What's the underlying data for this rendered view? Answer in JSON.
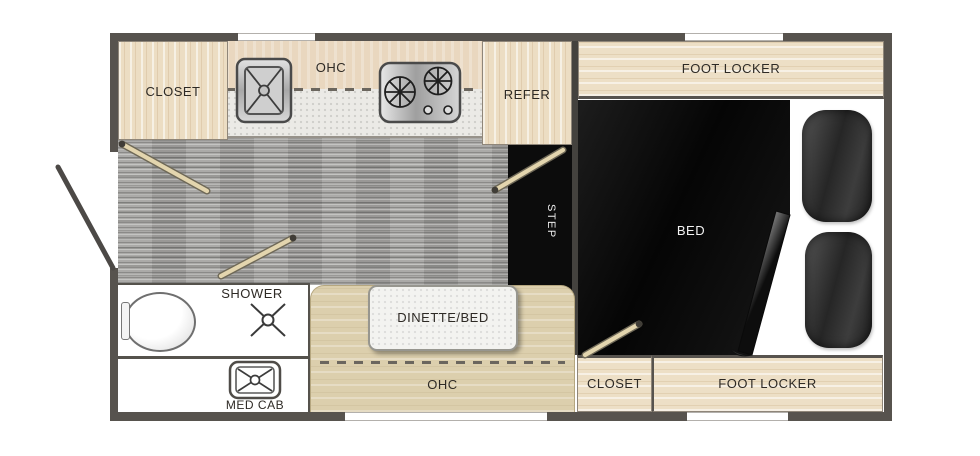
{
  "floorplan": {
    "kitchen": {
      "closet": "CLOSET",
      "ohc": "OHC",
      "refer": "REFER"
    },
    "front": {
      "foot_locker": "FOOT LOCKER",
      "bed": "BED",
      "step": "STEP"
    },
    "bath": {
      "shower": "SHOWER",
      "med_cab": "MED CAB"
    },
    "dinette": {
      "table": "DINETTE/BED",
      "ohc": "OHC"
    },
    "rear": {
      "closet": "CLOSET",
      "foot_locker": "FOOT LOCKER"
    },
    "icons": {
      "sink": "sink-icon",
      "stove": "stove-burners-icon",
      "toilet": "toilet-icon",
      "shower_drain": "shower-drain-icon",
      "med_cab": "med-cab-icon",
      "entry_door": "entry-door-swing-icon",
      "strut": "cabinet-strut-icon"
    },
    "colors": {
      "wall": "#57534e",
      "wood": "#ecddc3",
      "upper_cabinet": "#e9d7bf",
      "counter": "#ebeae6",
      "bench": "#dccfad",
      "floor": "#a5a4a1",
      "bed_black": "#0d0d0d",
      "label_dark": "#2e2a25",
      "label_light": "#f2f2f2"
    }
  }
}
